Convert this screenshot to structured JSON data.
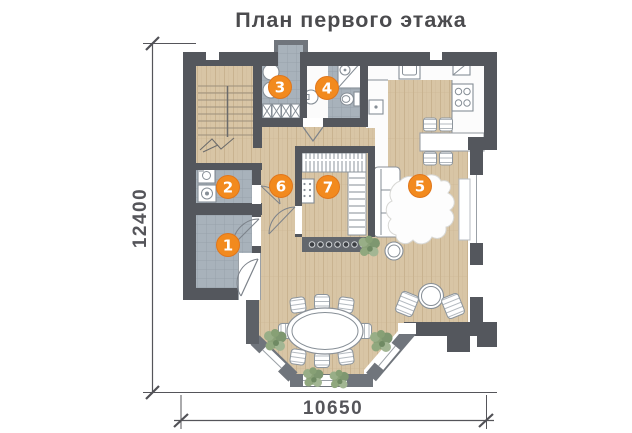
{
  "title": "План первого этажа",
  "dimensions": {
    "height_mm": "12400",
    "width_mm": "10650"
  },
  "rooms": [
    {
      "number": "1",
      "x": 228,
      "y": 245
    },
    {
      "number": "2",
      "x": 228,
      "y": 187
    },
    {
      "number": "3",
      "x": 280,
      "y": 87
    },
    {
      "number": "4",
      "x": 327,
      "y": 88
    },
    {
      "number": "5",
      "x": 420,
      "y": 186
    },
    {
      "number": "6",
      "x": 281,
      "y": 186
    },
    {
      "number": "7",
      "x": 328,
      "y": 187
    }
  ],
  "colors": {
    "accent": "#F28A1E",
    "accent_edge": "#E0761B",
    "wall": "#54575D",
    "wall_light": "#70757C",
    "tile": "#A8B2BB",
    "wood": "#D8C5A5",
    "kitchen_floor": "#FCFCFC",
    "plant": "#8FA57F",
    "text": "#4B4B4E"
  }
}
